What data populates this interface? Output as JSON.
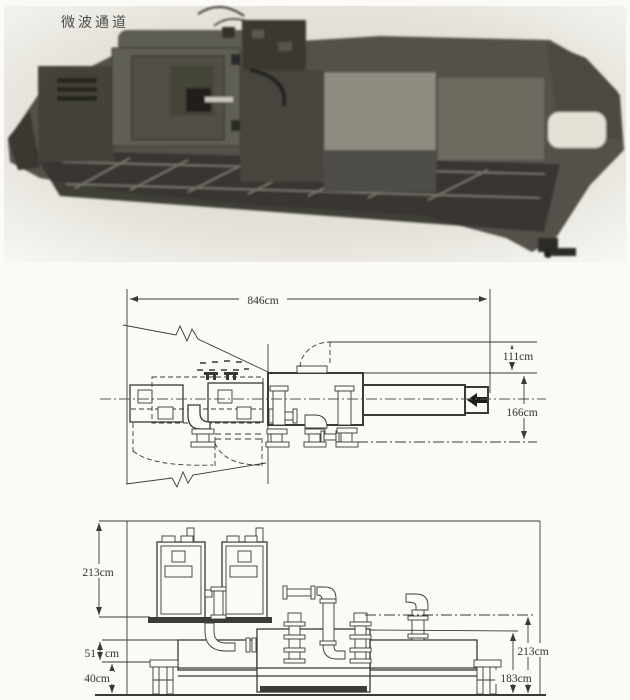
{
  "photo": {
    "caption": "微波通道"
  },
  "plan_view": {
    "length": "846cm",
    "inlet_offset": "111cm",
    "width": "166cm"
  },
  "elevation_view": {
    "cabinet_height": "213cm",
    "gap_value": "51",
    "gap_unit": "cm",
    "base_height": "40cm",
    "pipe_top_height": "213cm",
    "body_height": "183cm"
  },
  "colors": {
    "paper": "#fbfaf6",
    "ink": "#3a3934"
  }
}
